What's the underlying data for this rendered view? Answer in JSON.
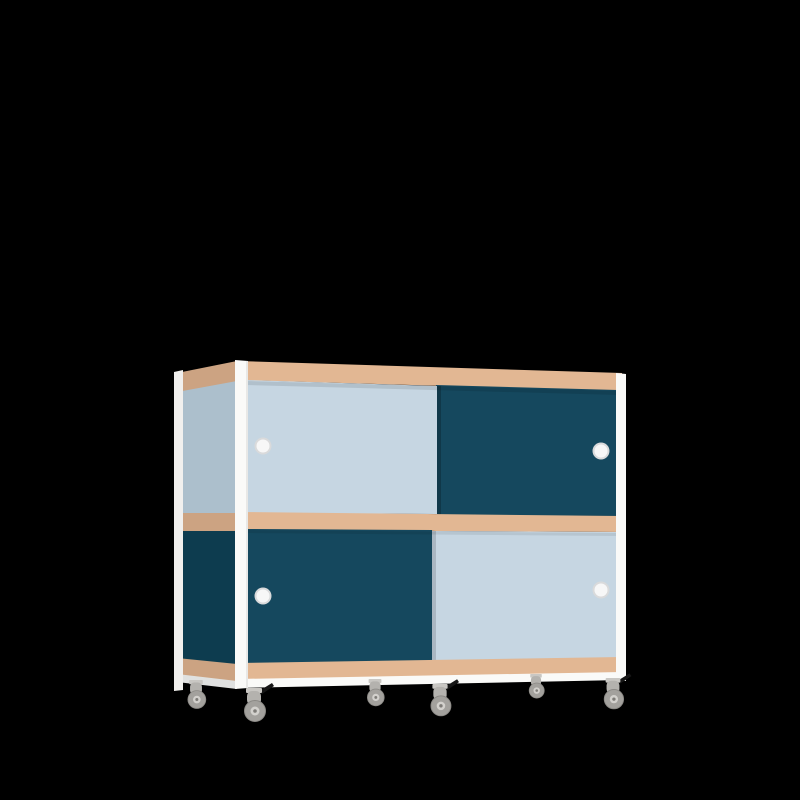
{
  "scene": {
    "description": "3D product render of a two-tier mobile sideboard cabinet with sliding doors, plywood edge bands, white frame and six swivel casters, on a black background",
    "background_color": "#000000"
  },
  "colors": {
    "background": "#000000",
    "frame_white": "#fafaf8",
    "frame_white_shade": "#ededeb",
    "frame_white_side": "#f1f0ee",
    "plywood_front": "#e2b793",
    "plywood_side": "#d7ab88",
    "door_light_blue": "#c6d6e2",
    "door_dark_teal": "#15485e",
    "side_light_blue": "#b6c9d6",
    "side_dark_teal": "#0e3f53",
    "handle_ring": "#d9dadb",
    "handle_white": "#f7f7f7",
    "caster_plate": "#c9c7c3",
    "caster_body": "#b4b2ae",
    "caster_wheel": "#a3a19d",
    "caster_wheel_rim": "#8b8985",
    "caster_hub": "#d3d1cd",
    "caster_axle": "#7e7c78",
    "brake_black": "#161616"
  },
  "cabinet": {
    "tiers": [
      {
        "name": "upper",
        "doors": [
          {
            "position": "front-left",
            "color": "light-blue",
            "handle_side": "left"
          },
          {
            "position": "back-right",
            "color": "dark-teal",
            "handle_side": "right"
          }
        ]
      },
      {
        "name": "lower",
        "doors": [
          {
            "position": "front-left",
            "color": "dark-teal",
            "handle_side": "left"
          },
          {
            "position": "back-right",
            "color": "light-blue",
            "handle_side": "right"
          }
        ]
      }
    ],
    "handle_count": 4,
    "caster_count": 6,
    "casters_with_brake": 3
  }
}
